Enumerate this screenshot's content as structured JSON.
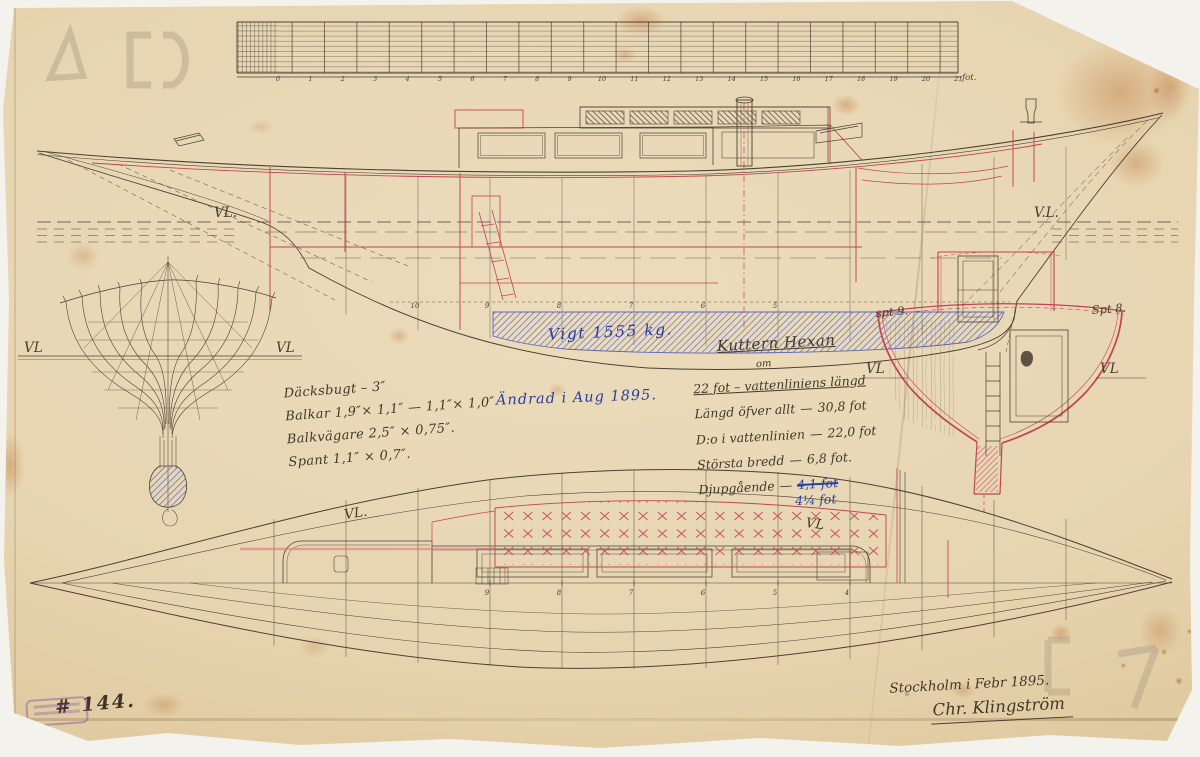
{
  "drawing_number": "# 144.",
  "scale_bar": {
    "numbers": [
      "0",
      "1",
      "2",
      "3",
      "4",
      "5",
      "6",
      "7",
      "8",
      "9",
      "10",
      "11",
      "12",
      "13",
      "14",
      "15",
      "16",
      "17",
      "18",
      "19",
      "20",
      "21"
    ],
    "unit": "fot."
  },
  "annotations": {
    "scantlings": [
      "Däcksbugt – 3″",
      "Balkar 1,9″× 1,1″ — 1,1″× 1,0″",
      "Balkvägare 2,5″ × 0,75″.",
      "Spant 1,1″ × 0,7″."
    ],
    "revision_note": "Ändrad i Aug 1895.",
    "keel_weight": "Vigt 1555 kg."
  },
  "title_block": {
    "title": "Kuttern Hexan",
    "subtitle": "om",
    "waterline_line": "22 fot – vattenliniens längd",
    "dash": "—",
    "specs": [
      {
        "label": "Längd öfver allt",
        "value": "30,8 fot"
      },
      {
        "label": "D:o i vattenlinien",
        "value": "22,0 fot"
      },
      {
        "label": "Största bredd",
        "value": "6,8 fot."
      },
      {
        "label": "Djupgående",
        "value_old": "4,1 fot",
        "value_new": "4¼ fot"
      }
    ]
  },
  "signature": {
    "place_date": "Stockholm i Febr 1895.",
    "name": "Chr. Klingström"
  },
  "labels": {
    "vl_profile_bow": "VL.",
    "vl_profile_stern": "V.L.",
    "vl_body_left": "VL",
    "vl_body_right": "VL",
    "vl_section_left": "VL",
    "vl_section_right": "VL",
    "vl_plan_fwd": "VL.",
    "vl_plan_aft": "VL",
    "section_left": "spt 9.",
    "section_right": "Spt 8."
  },
  "profile": {
    "station_numbers": [
      "10",
      "9",
      "8",
      "7",
      "6",
      "5"
    ]
  },
  "plan": {
    "station_numbers": [
      "9",
      "8",
      "7",
      "6",
      "5",
      "4"
    ]
  }
}
